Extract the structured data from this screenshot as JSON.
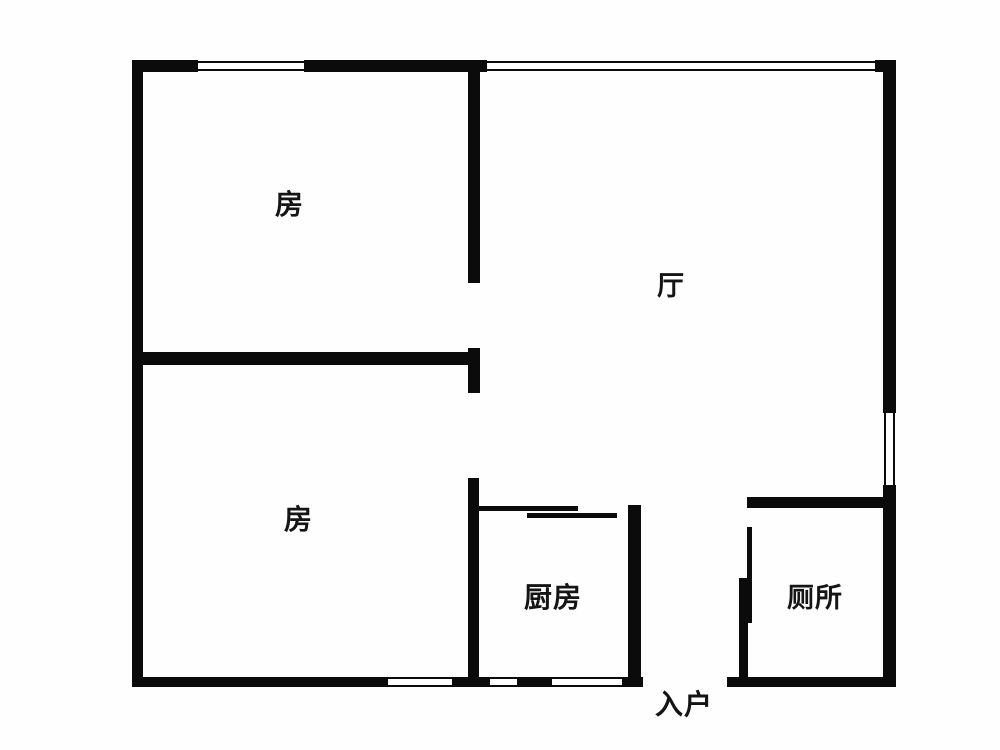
{
  "plan": {
    "type": "apartment-floor-plan",
    "background_color": "#fefefe",
    "wall_color": "#0b0b0b",
    "labels": {
      "bedroom_top": "房",
      "bedroom_bottom": "房",
      "living": "厅",
      "kitchen": "厨房",
      "toilet": "厕所",
      "entrance": "入户"
    }
  }
}
